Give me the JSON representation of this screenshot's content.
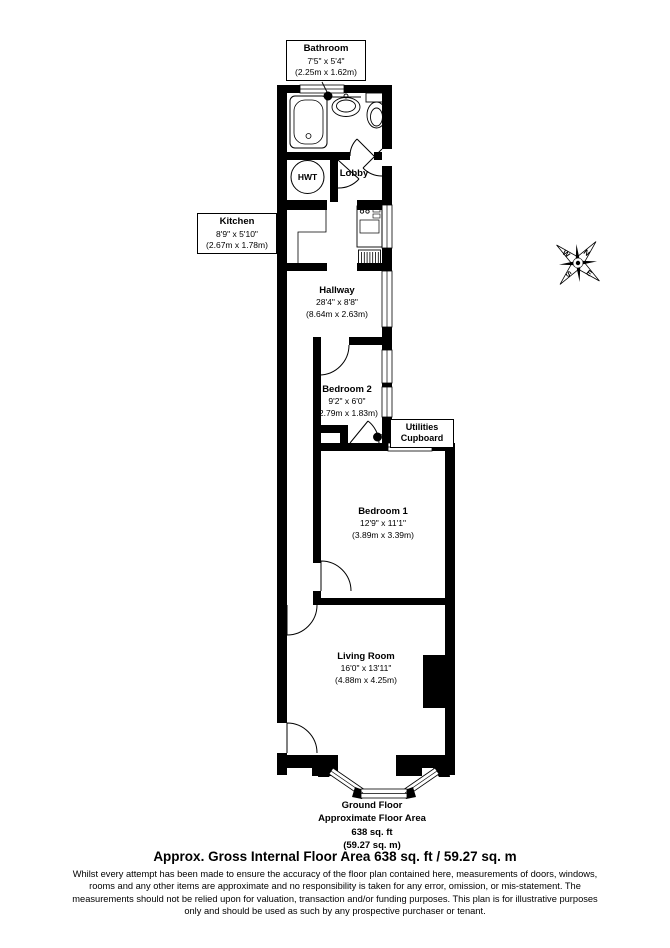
{
  "plan": {
    "rooms": {
      "bathroom": {
        "name": "Bathroom",
        "dims_imperial": "7'5\" x 5'4\"",
        "dims_metric": "(2.25m x 1.62m)"
      },
      "kitchen": {
        "name": "Kitchen",
        "dims_imperial": "8'9\" x 5'10\"",
        "dims_metric": "(2.67m x 1.78m)"
      },
      "hwt": {
        "name": "HWT"
      },
      "lobby": {
        "name": "Lobby"
      },
      "hallway": {
        "name": "Hallway",
        "dims_imperial": "28'4\" x 8'8\"",
        "dims_metric": "(8.64m x 2.63m)"
      },
      "bedroom2": {
        "name": "Bedroom 2",
        "dims_imperial": "9'2\" x 6'0\"",
        "dims_metric": "(2.79m x 1.83m)"
      },
      "utilities": {
        "line1": "Utilities",
        "line2": "Cupboard"
      },
      "bedroom1": {
        "name": "Bedroom 1",
        "dims_imperial": "12'9\" x 11'1\"",
        "dims_metric": "(3.89m x 3.39m)"
      },
      "living": {
        "name": "Living Room",
        "dims_imperial": "16'0\" x 13'11\"",
        "dims_metric": "(4.88m x 4.25m)"
      }
    },
    "floor_summary": {
      "line1": "Ground Floor",
      "line2": "Approximate Floor Area",
      "line3": "638 sq. ft",
      "line4": "(59.27 sq. m)"
    },
    "compass": {
      "n": "N",
      "e": "E",
      "s": "S",
      "w": "W"
    }
  },
  "footer": {
    "title": "Approx. Gross Internal Floor Area 638 sq. ft / 59.27 sq. m",
    "disclaimer_lines": [
      "Whilst every attempt has been made to ensure the accuracy of the floor plan contained here, measurements of doors, windows,",
      "rooms and any other items are approximate and no responsibility is taken for any error, omission, or mis-statement. The",
      "measurements should not be relied upon for valuation, transaction and/or funding purposes. This plan is for illustrative purposes",
      "only and should be used as such by any prospective purchaser or tenant."
    ]
  },
  "colors": {
    "wall": "#000000",
    "line": "#1a1a1a",
    "background": "#ffffff"
  }
}
